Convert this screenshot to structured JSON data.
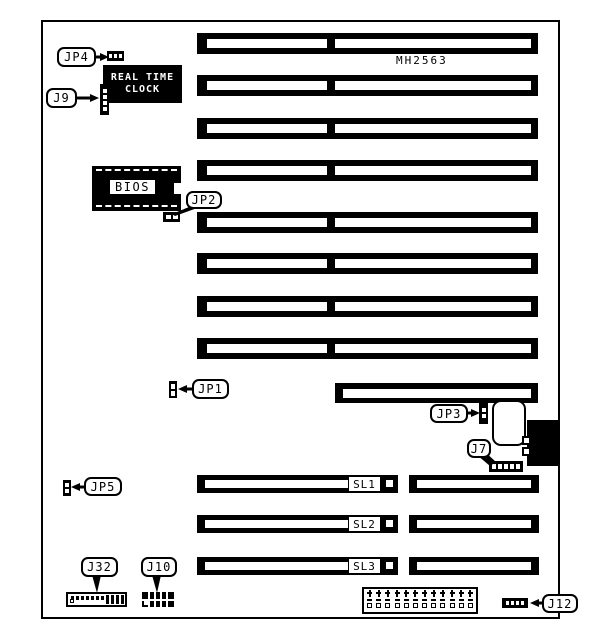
{
  "diagram": {
    "part_number": "MH2563",
    "rtc": {
      "line1": "REAL TIME",
      "line2": "CLOCK"
    },
    "bios_label": "BIOS",
    "callouts": {
      "jp4": "JP4",
      "j9": "J9",
      "jp2": "JP2",
      "jp1": "JP1",
      "jp3": "JP3",
      "j7": "J7",
      "jp5": "JP5",
      "j32": "J32",
      "j10": "J10",
      "j12": "J12"
    },
    "slot_labels": {
      "sl1": "SL1",
      "sl2": "SL2",
      "sl3": "SL3"
    },
    "colors": {
      "ink": "#000000",
      "background": "#ffffff"
    }
  }
}
